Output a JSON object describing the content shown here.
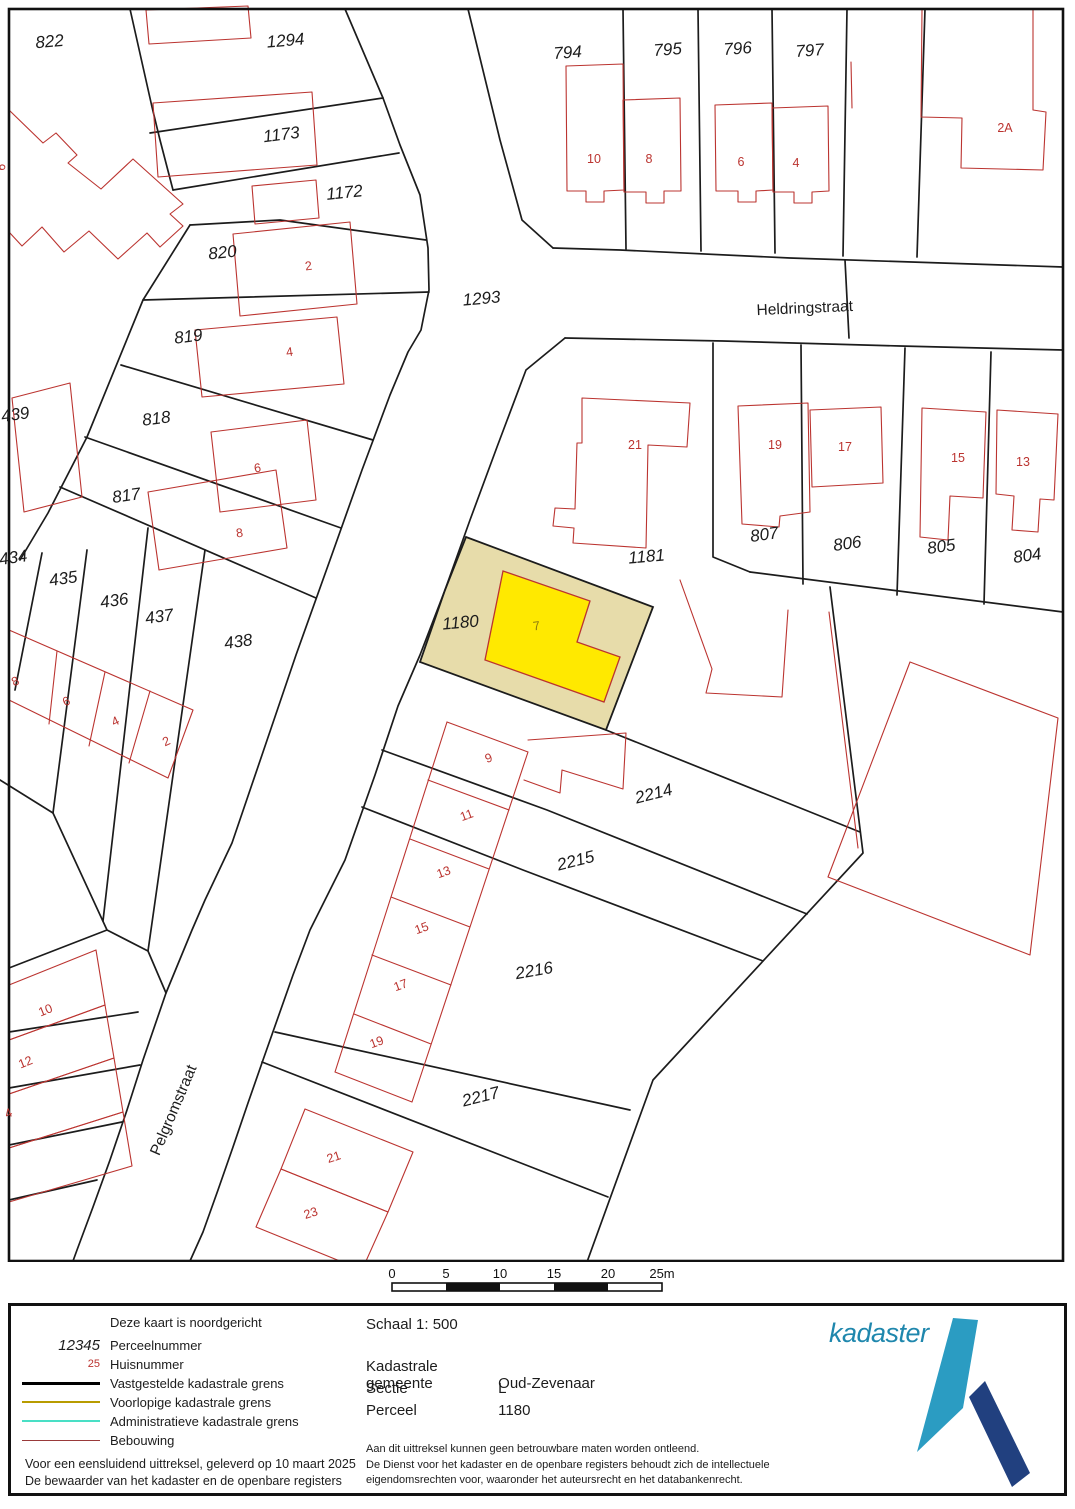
{
  "map": {
    "highlighted_parcel": {
      "parcel": "1180",
      "house_number": "7"
    },
    "parcel_labels": [
      {
        "text": "822",
        "x": 50,
        "y": 47,
        "rot": -5
      },
      {
        "text": "1294",
        "x": 286,
        "y": 46,
        "rot": -5
      },
      {
        "text": "1173",
        "x": 282,
        "y": 140,
        "rot": -7
      },
      {
        "text": "1172",
        "x": 345,
        "y": 198,
        "rot": -6
      },
      {
        "text": "820",
        "x": 223,
        "y": 258,
        "rot": -6
      },
      {
        "text": "819",
        "x": 189,
        "y": 342,
        "rot": -7
      },
      {
        "text": "818",
        "x": 157,
        "y": 424,
        "rot": -7
      },
      {
        "text": "817",
        "x": 127,
        "y": 501,
        "rot": -8
      },
      {
        "text": "439",
        "x": 16,
        "y": 420,
        "rot": -8
      },
      {
        "text": "434",
        "x": 14,
        "y": 563,
        "rot": -8
      },
      {
        "text": "435",
        "x": 64,
        "y": 584,
        "rot": -8
      },
      {
        "text": "436",
        "x": 115,
        "y": 606,
        "rot": -8
      },
      {
        "text": "437",
        "x": 160,
        "y": 622,
        "rot": -8
      },
      {
        "text": "438",
        "x": 239,
        "y": 647,
        "rot": -8
      },
      {
        "text": "1293",
        "x": 482,
        "y": 304,
        "rot": -5
      },
      {
        "text": "794",
        "x": 568,
        "y": 58,
        "rot": -4
      },
      {
        "text": "795",
        "x": 668,
        "y": 55,
        "rot": -4
      },
      {
        "text": "796",
        "x": 738,
        "y": 54,
        "rot": -4
      },
      {
        "text": "797",
        "x": 810,
        "y": 56,
        "rot": -4
      },
      {
        "text": "807",
        "x": 765,
        "y": 540,
        "rot": -8
      },
      {
        "text": "806",
        "x": 848,
        "y": 549,
        "rot": -8
      },
      {
        "text": "805",
        "x": 942,
        "y": 552,
        "rot": -8
      },
      {
        "text": "804",
        "x": 1028,
        "y": 561,
        "rot": -8
      },
      {
        "text": "1181",
        "x": 647,
        "y": 562,
        "rot": -5
      },
      {
        "text": "1180",
        "x": 461,
        "y": 628,
        "rot": -5
      },
      {
        "text": "2214",
        "x": 655,
        "y": 799,
        "rot": -14
      },
      {
        "text": "2215",
        "x": 577,
        "y": 866,
        "rot": -14
      },
      {
        "text": "2216",
        "x": 535,
        "y": 976,
        "rot": -10
      },
      {
        "text": "2217",
        "x": 482,
        "y": 1102,
        "rot": -14
      }
    ],
    "house_numbers": [
      {
        "text": "2",
        "x": 309,
        "y": 270,
        "rot": -8
      },
      {
        "text": "4",
        "x": 290,
        "y": 356,
        "rot": -8
      },
      {
        "text": "6",
        "x": 258,
        "y": 472,
        "rot": -8
      },
      {
        "text": "8",
        "x": 240,
        "y": 537,
        "rot": -8
      },
      {
        "text": "8",
        "x": 17,
        "y": 685,
        "rot": -25
      },
      {
        "text": "6",
        "x": 68,
        "y": 705,
        "rot": -25
      },
      {
        "text": "4",
        "x": 117,
        "y": 725,
        "rot": -25
      },
      {
        "text": "2",
        "x": 168,
        "y": 745,
        "rot": -25
      },
      {
        "text": "10",
        "x": 594,
        "y": 163,
        "rot": 0
      },
      {
        "text": "8",
        "x": 649,
        "y": 163,
        "rot": 0
      },
      {
        "text": "6",
        "x": 741,
        "y": 166,
        "rot": 0
      },
      {
        "text": "4",
        "x": 796,
        "y": 167,
        "rot": 0
      },
      {
        "text": "2A",
        "x": 1005,
        "y": 132,
        "rot": 0
      },
      {
        "text": "21",
        "x": 635,
        "y": 449,
        "rot": 0
      },
      {
        "text": "19",
        "x": 775,
        "y": 449,
        "rot": 0
      },
      {
        "text": "17",
        "x": 845,
        "y": 451,
        "rot": 0
      },
      {
        "text": "15",
        "x": 958,
        "y": 462,
        "rot": 0
      },
      {
        "text": "13",
        "x": 1023,
        "y": 466,
        "rot": 0
      },
      {
        "text": "7",
        "x": 537,
        "y": 630,
        "rot": -8,
        "olive": true
      },
      {
        "text": "9",
        "x": 490,
        "y": 762,
        "rot": -20
      },
      {
        "text": "11",
        "x": 468,
        "y": 819,
        "rot": -20
      },
      {
        "text": "13",
        "x": 445,
        "y": 876,
        "rot": -20
      },
      {
        "text": "15",
        "x": 423,
        "y": 932,
        "rot": -20
      },
      {
        "text": "17",
        "x": 402,
        "y": 989,
        "rot": -20
      },
      {
        "text": "19",
        "x": 378,
        "y": 1046,
        "rot": -20
      },
      {
        "text": "21",
        "x": 335,
        "y": 1161,
        "rot": -18
      },
      {
        "text": "23",
        "x": 312,
        "y": 1217,
        "rot": -18
      },
      {
        "text": "10",
        "x": 47,
        "y": 1014,
        "rot": -22
      },
      {
        "text": "12",
        "x": 27,
        "y": 1066,
        "rot": -22
      },
      {
        "text": "4",
        "x": 10,
        "y": 1117,
        "rot": -22
      },
      {
        "text": "6",
        "x": 5,
        "y": 168,
        "rot": -75
      }
    ],
    "street_names": [
      {
        "text": "Heldringstraat",
        "x": 805,
        "y": 313,
        "rot": -2.5
      },
      {
        "text": "Pelgromstraat",
        "x": 178,
        "y": 1112,
        "rot": -67
      }
    ]
  },
  "scalebar": {
    "ticks": [
      "0",
      "5",
      "10",
      "15",
      "20",
      "25m"
    ]
  },
  "legend": {
    "north_note": "Deze kaart is noordgericht",
    "perceel_symbol": "12345",
    "perceel_label": "Perceelnummer",
    "huis_symbol": "25",
    "huis_label": "Huisnummer",
    "line_items": [
      {
        "label": "Vastgestelde kadastrale grens",
        "color": "#000000",
        "weight": 3
      },
      {
        "label": "Voorlopige kadastrale grens",
        "color": "#b89c00",
        "weight": 2
      },
      {
        "label": "Administratieve kadastrale grens",
        "color": "#49dfc5",
        "weight": 2
      },
      {
        "label": "Bebouwing",
        "color": "#993a3a",
        "weight": 1.5
      }
    ],
    "issued_line1": "Voor een eensluidend uittreksel, geleverd op 10 maart 2025",
    "issued_line2": "De bewaarder van het kadaster en de openbare registers"
  },
  "info": {
    "schaal": "Schaal 1: 500",
    "rows": [
      {
        "label": "Kadastrale gemeente",
        "value": "Oud-Zevenaar"
      },
      {
        "label": "Sectie",
        "value": "L"
      },
      {
        "label": "Perceel",
        "value": "1180"
      }
    ],
    "disclaimer1": "Aan dit uittreksel kunnen geen betrouwbare maten worden ontleend.",
    "disclaimer2": "De Dienst voor het kadaster en de openbare registers behoudt zich de intellectuele",
    "disclaimer3": "eigendomsrechten voor, waaronder het auteursrecht en het databankenrecht.",
    "logo_text": "kadaster"
  },
  "colors": {
    "boundary": "#1c1c1c",
    "building_outline": "#bb3430",
    "highlight_parcel_fill": "#e7dcaa",
    "highlight_building_fill": "#ffe900",
    "highlight_number": "#8b7a10",
    "logo_blue": "#1f87ad",
    "logo_teal": "#2b9cc2",
    "logo_navy": "#21407f"
  }
}
